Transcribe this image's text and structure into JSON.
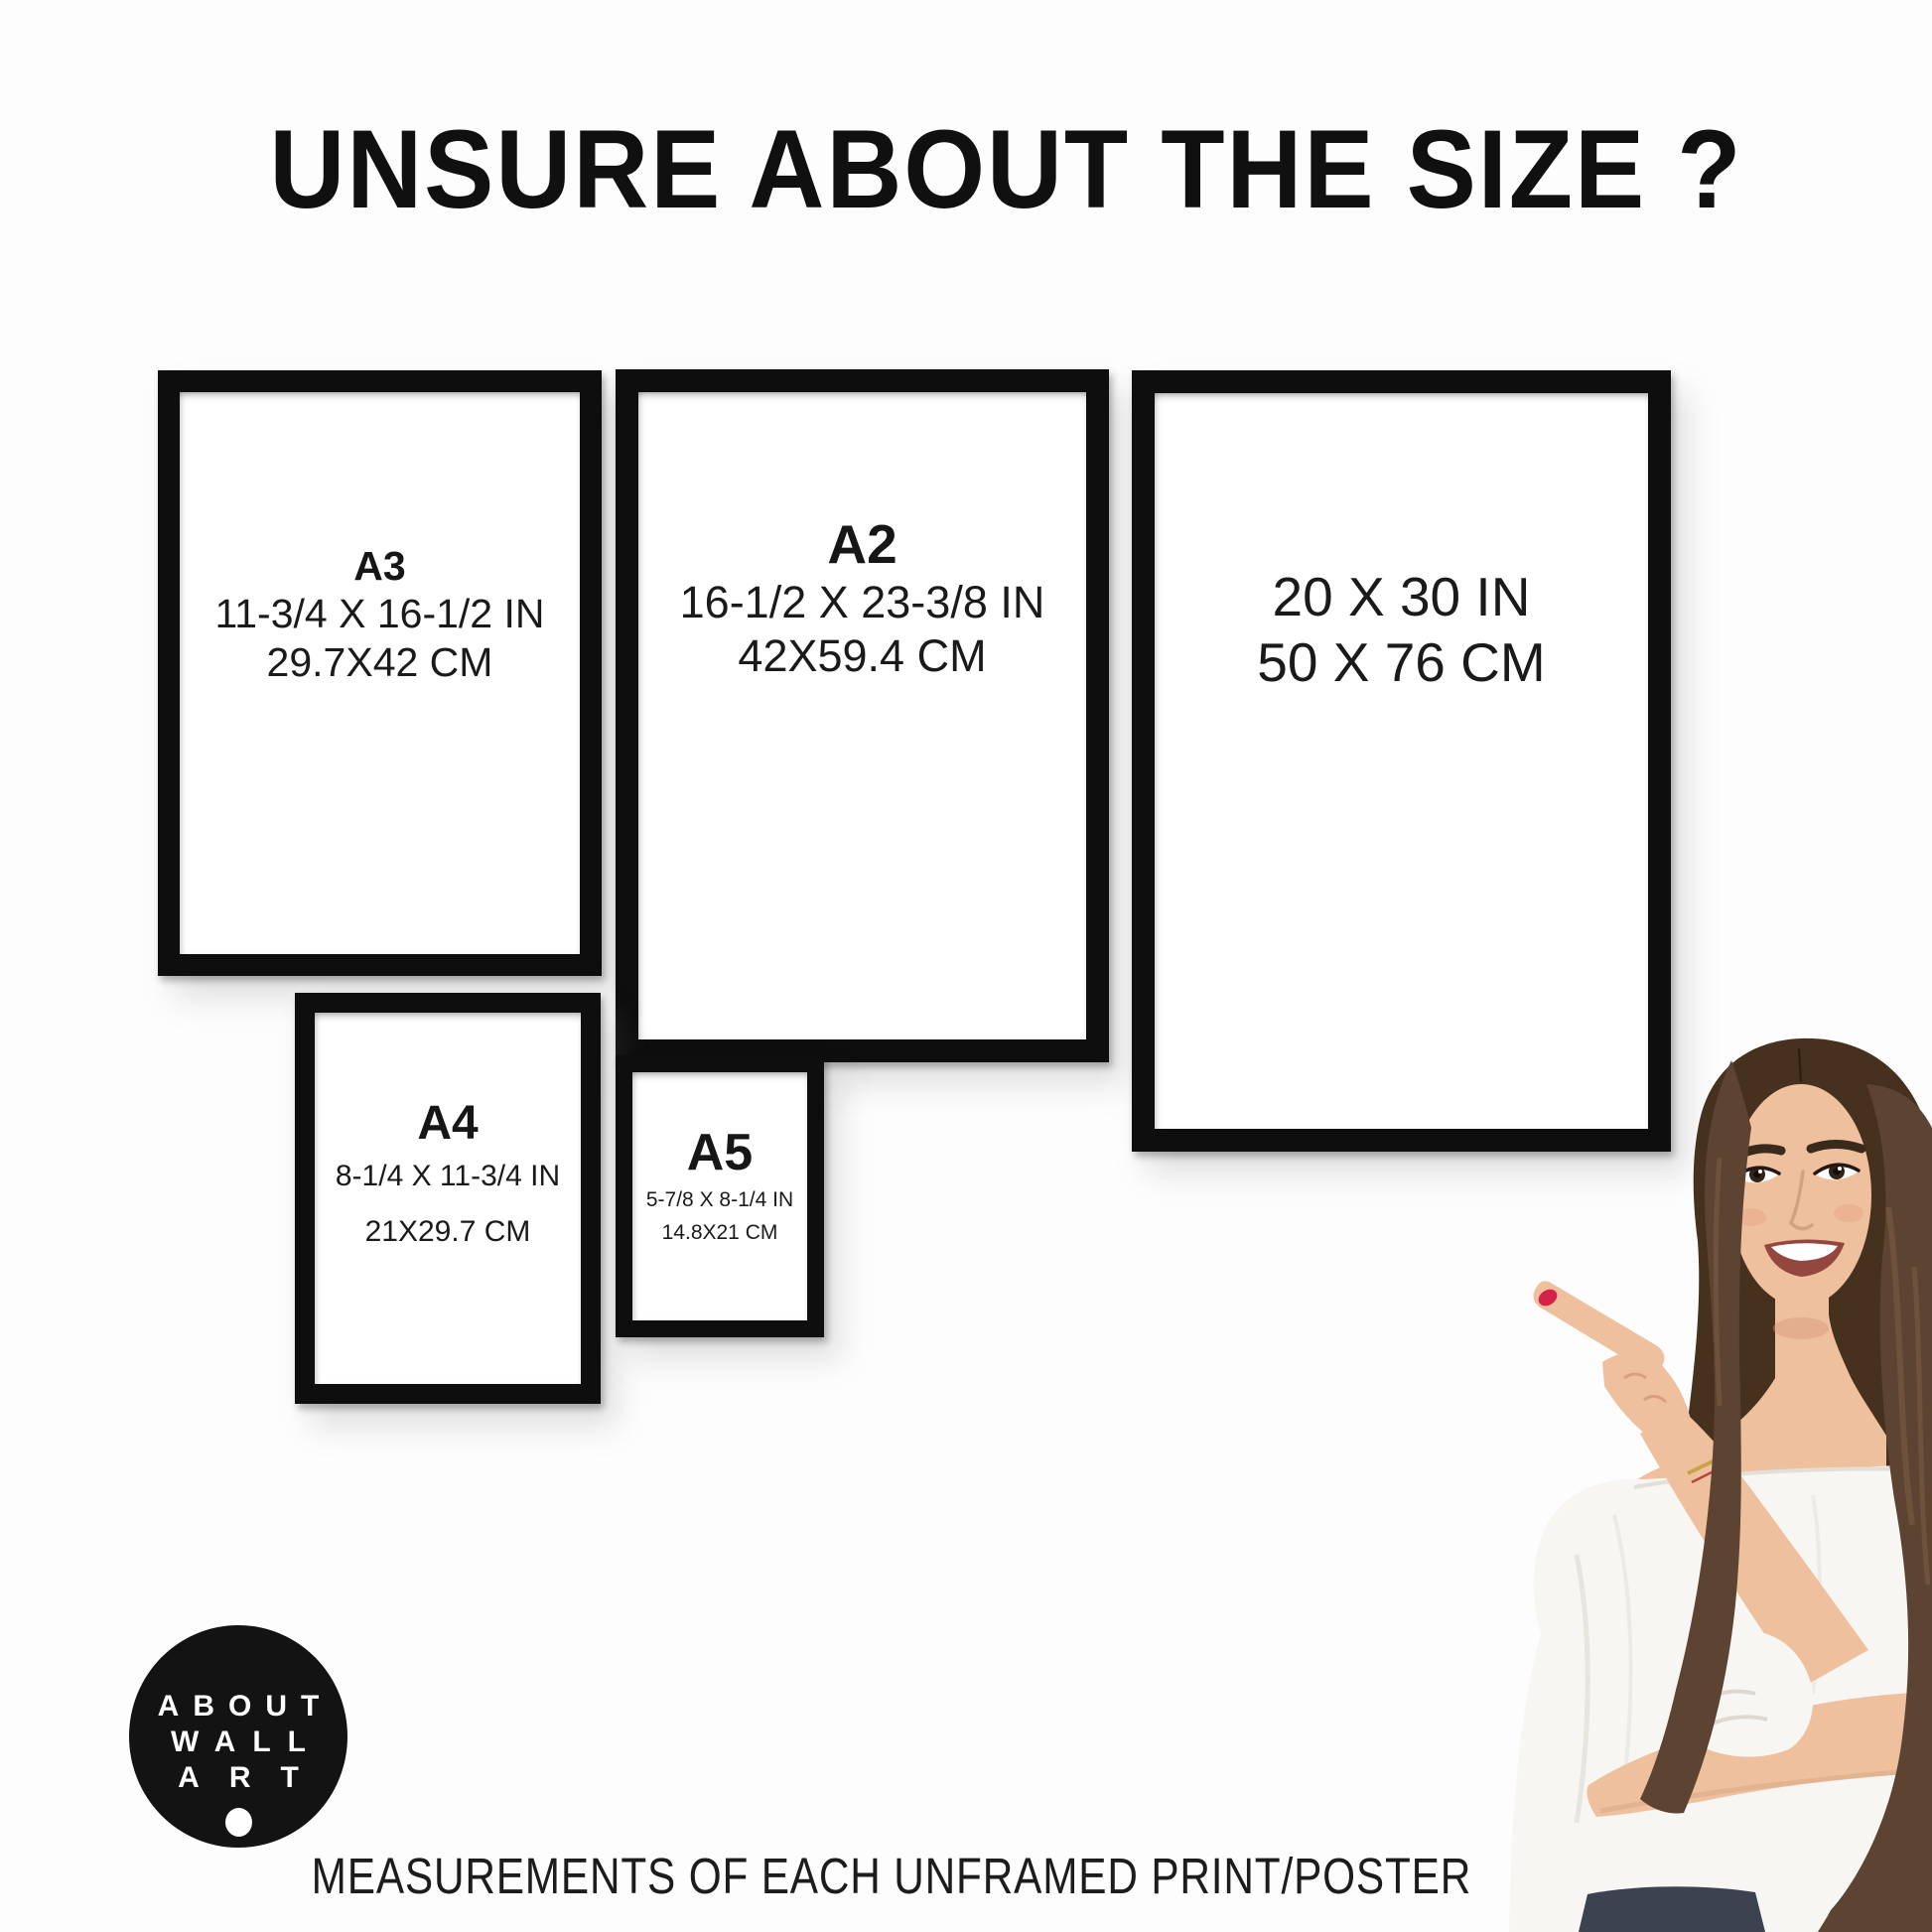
{
  "header": {
    "title": "UNSURE ABOUT THE SIZE ?"
  },
  "frames": [
    {
      "label": "A3",
      "inches": "11-3/4 X 16-1/2 IN",
      "cm": "29.7X42 CM"
    },
    {
      "label": "A2",
      "inches": "16-1/2 X 23-3/8 IN",
      "cm": "42X59.4 CM"
    },
    {
      "label": "",
      "inches": "20 X 30 IN",
      "cm": "50 X 76 CM"
    },
    {
      "label": "A4",
      "inches": "8-1/4 X 11-3/4 IN",
      "cm": "21X29.7 CM"
    },
    {
      "label": "A5",
      "inches": "5-7/8 X 8-1/4 IN",
      "cm": "14.8X21 CM"
    }
  ],
  "logo": {
    "line1": "ABOUT",
    "line2": "WALL",
    "line3": "ART"
  },
  "footer": {
    "caption": "MEASUREMENTS OF EACH UNFRAMED PRINT/POSTER"
  },
  "colors": {
    "frame_black": "#0e0e0e",
    "text": "#1a1a1a",
    "logo_bg": "#131313",
    "logo_text": "#ffffff",
    "hair_dark": "#46311f",
    "hair_mid": "#5d4432",
    "skin": "#eec09e",
    "blouse": "#f8f6f3",
    "jeans": "#3c4250",
    "nail": "#d4224d"
  }
}
